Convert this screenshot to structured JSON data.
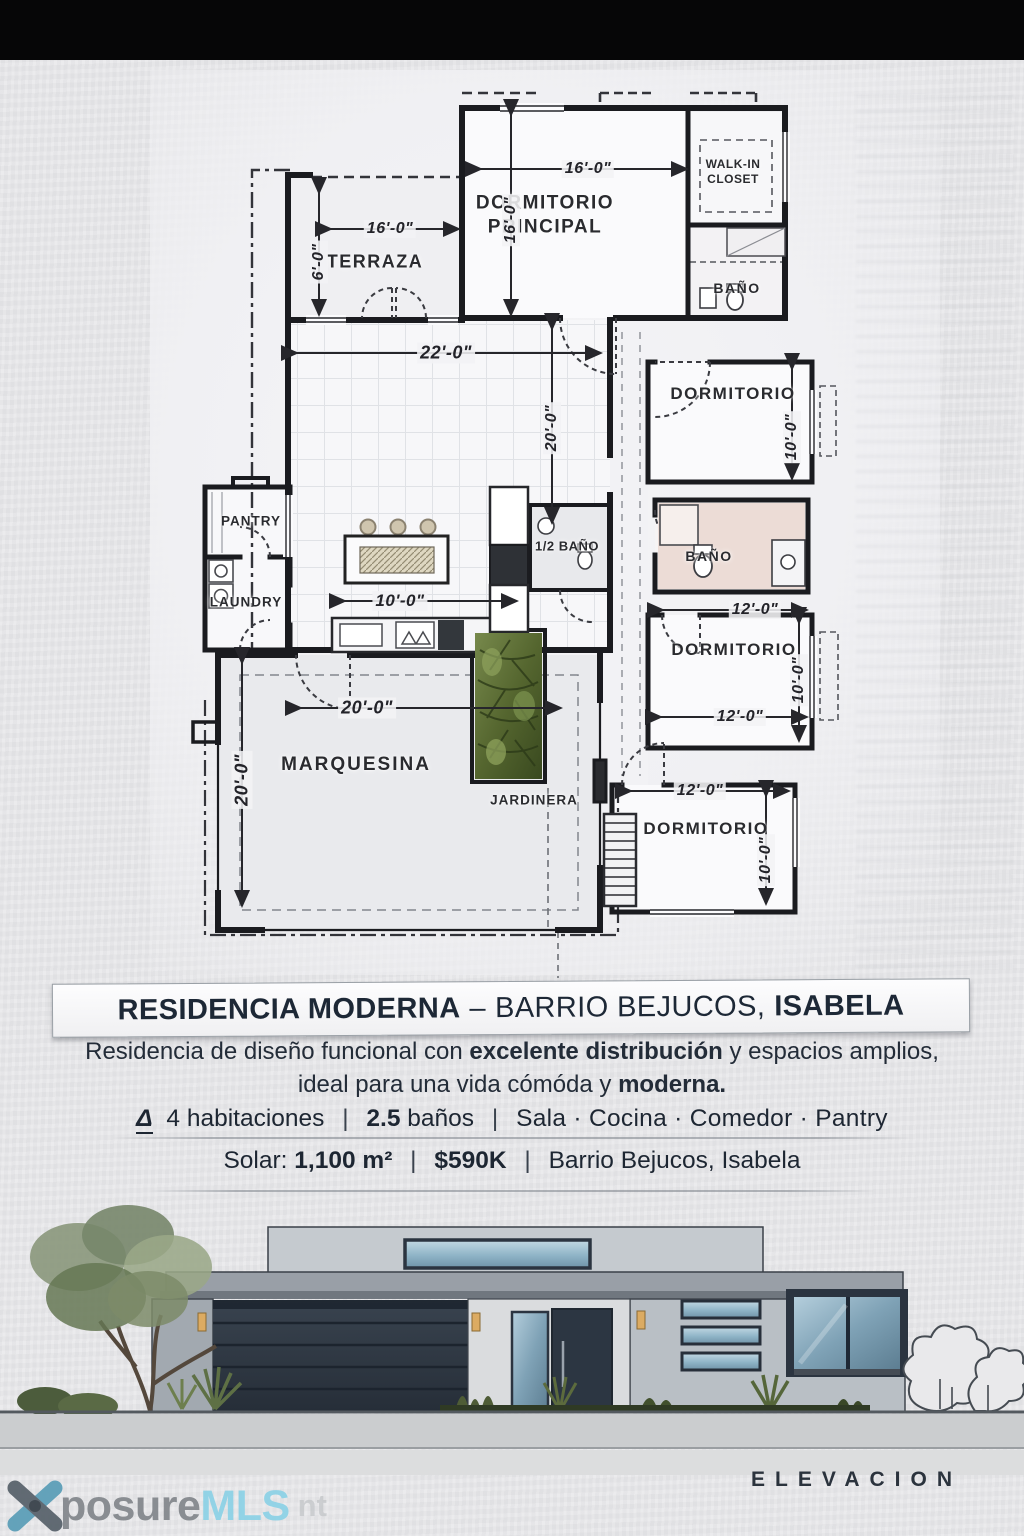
{
  "top_bar": {
    "color": "#060607"
  },
  "floor_plan": {
    "rooms": [
      {
        "id": "terraza",
        "label": "TERRAZA"
      },
      {
        "id": "dormitorio_principal",
        "label": "DORMITORIO PRINCIPAL"
      },
      {
        "id": "walk_in_closet",
        "label": "WALK-IN CLOSET"
      },
      {
        "id": "bano_principal",
        "label": "BAÑO"
      },
      {
        "id": "dormitorio_2",
        "label": "DORMITORIO"
      },
      {
        "id": "half_bano",
        "label": "1/2 BAÑO"
      },
      {
        "id": "bano_2",
        "label": "BAÑO"
      },
      {
        "id": "dormitorio_3",
        "label": "DORMITORIO"
      },
      {
        "id": "dormitorio_4",
        "label": "DORMITORIO"
      },
      {
        "id": "pantry",
        "label": "PANTRY"
      },
      {
        "id": "laundry",
        "label": "LAUNDRY"
      },
      {
        "id": "marquesina",
        "label": "MARQUESINA"
      },
      {
        "id": "jardinera",
        "label": "JARDINERA"
      }
    ],
    "dimensions": [
      {
        "id": "dorm_principal_width",
        "label": "16'-0\""
      },
      {
        "id": "dorm_principal_depth",
        "label": "16'-0\""
      },
      {
        "id": "terraza_width",
        "label": "16'-0\""
      },
      {
        "id": "terraza_depth",
        "label": "6'-0\""
      },
      {
        "id": "sala_width",
        "label": "22'-0\""
      },
      {
        "id": "sala_depth",
        "label": "20'-0\""
      },
      {
        "id": "cocina_width",
        "label": "10'-0\""
      },
      {
        "id": "marquesina_width",
        "label": "20'-0\""
      },
      {
        "id": "marquesina_depth",
        "label": "20'-0\""
      },
      {
        "id": "dormitorio_2_depth",
        "label": "10'-0\""
      },
      {
        "id": "dormitorio_3_width_top",
        "label": "12'-0\""
      },
      {
        "id": "dormitorio_3_depth",
        "label": "10'-0\""
      },
      {
        "id": "dormitorio_3_width_bottom",
        "label": "12'-0\""
      },
      {
        "id": "dormitorio_4_width",
        "label": "12'-0\""
      },
      {
        "id": "dormitorio_4_depth",
        "label": "10'-0\""
      }
    ]
  },
  "info": {
    "title": {
      "name": "RESIDENCIA MODERNA",
      "dash": "–",
      "barrio": "BARRIO BEJUCOS,",
      "city": "ISABELA"
    },
    "description": {
      "line1_pre": "Residencia de diseño funcional con ",
      "line1_bold": "excelente distribución",
      "line1_post": " y espacios amplios,",
      "line2_pre": "ideal para una vida cómóda y ",
      "line2_bold": "moderna."
    },
    "features": {
      "icon_glyph": "Δ",
      "habitaciones": "4 habitaciones",
      "sep": "|",
      "banos_value": "2.5",
      "banos_label": "baños",
      "spaces": "Sala · Cocina · Comedor · Pantry"
    },
    "solar": {
      "label": "Solar:",
      "area": "1,100 m²",
      "sep": "|",
      "price": "$590K",
      "location": "Barrio Bejucos, Isabela"
    }
  },
  "elevation": {
    "caption": "ELEVACION",
    "colors": {
      "garage_door": "#2e3742",
      "entry_door": "#2c3642",
      "window_glass": "#9ec2d4",
      "wall_gray": "#b9bfc5",
      "roof_gray": "#979ea6"
    }
  },
  "watermark": {
    "brand_gray": "posure",
    "brand_blue": "MLS",
    "ghost": "nt"
  }
}
